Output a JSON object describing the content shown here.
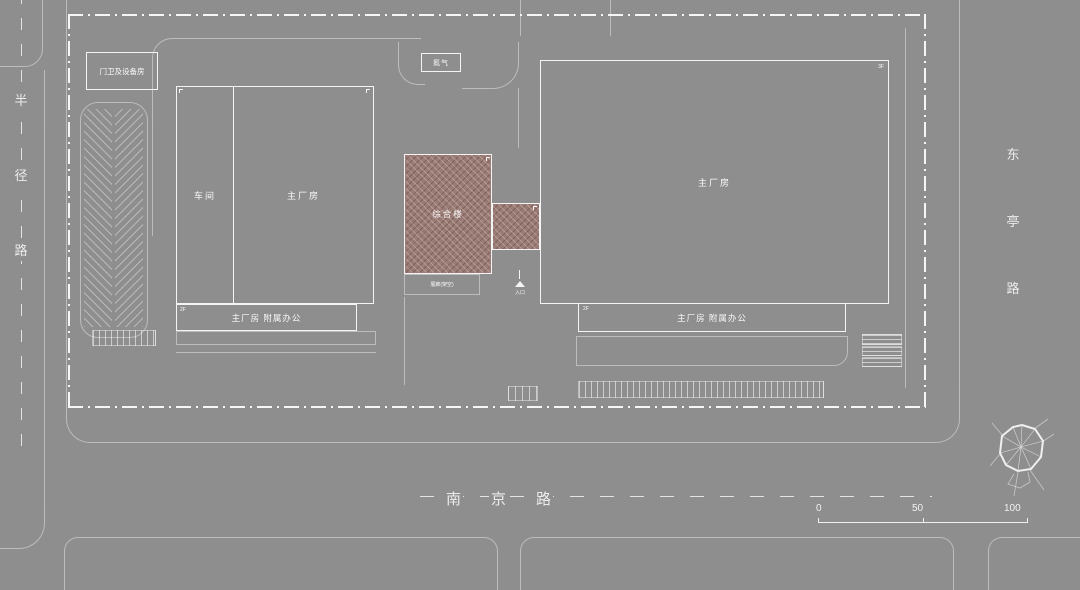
{
  "plan": {
    "roads": {
      "west": {
        "name": "半径路",
        "chars": [
          "半",
          "径",
          "路"
        ]
      },
      "east": {
        "name": "东亭路",
        "chars": [
          "东",
          "亭",
          "路"
        ]
      },
      "south": {
        "name": "南京路",
        "chars": [
          "南",
          "京",
          "路"
        ]
      }
    },
    "buildings": {
      "gatehouse": "门卫及设备房",
      "nitrogen": "氮气",
      "workshop": "车间",
      "factory_west": "主厂房",
      "annex_west": "主厂房 附属办公",
      "complex": "综合楼",
      "gallery": "展廊(架空)",
      "entrance": "入口",
      "factory_east": "主厂房",
      "annex_east": "主厂房 附属办公"
    },
    "floor_tags": {
      "annex_west": "2F",
      "annex_east": "2F",
      "factory_east": "3F"
    },
    "scale_bar": {
      "ticks": [
        "0",
        "50",
        "100"
      ]
    },
    "colors": {
      "background": "#8e8e8e",
      "line_white": "#f4f4f4",
      "line_light": "rgba(243,243,243,0.45)",
      "complex_fill": "#9a7c76"
    }
  }
}
